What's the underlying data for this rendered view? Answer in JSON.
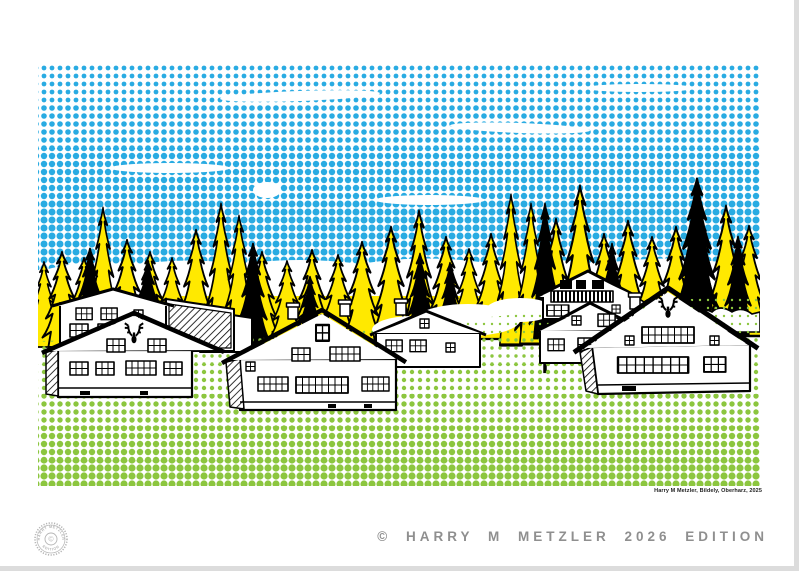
{
  "poster": {
    "caption": "© HARRY M METZLER 2026 EDITION",
    "signature": "Harry M Metzler, Bildely, Oberharz, 2025",
    "stamp": {
      "top_text": "HARRY METZLER",
      "bottom_text": "EDITION",
      "center_symbol": "©"
    }
  },
  "colors": {
    "sky_blue": "#29ABE2",
    "grass_green": "#8CC63F",
    "tree_yellow": "#FFE900",
    "line_black": "#000000",
    "caption_gray": "#8F8F8F",
    "stamp_gray": "#B5B5B5",
    "paper_white": "#FFFFFF"
  }
}
